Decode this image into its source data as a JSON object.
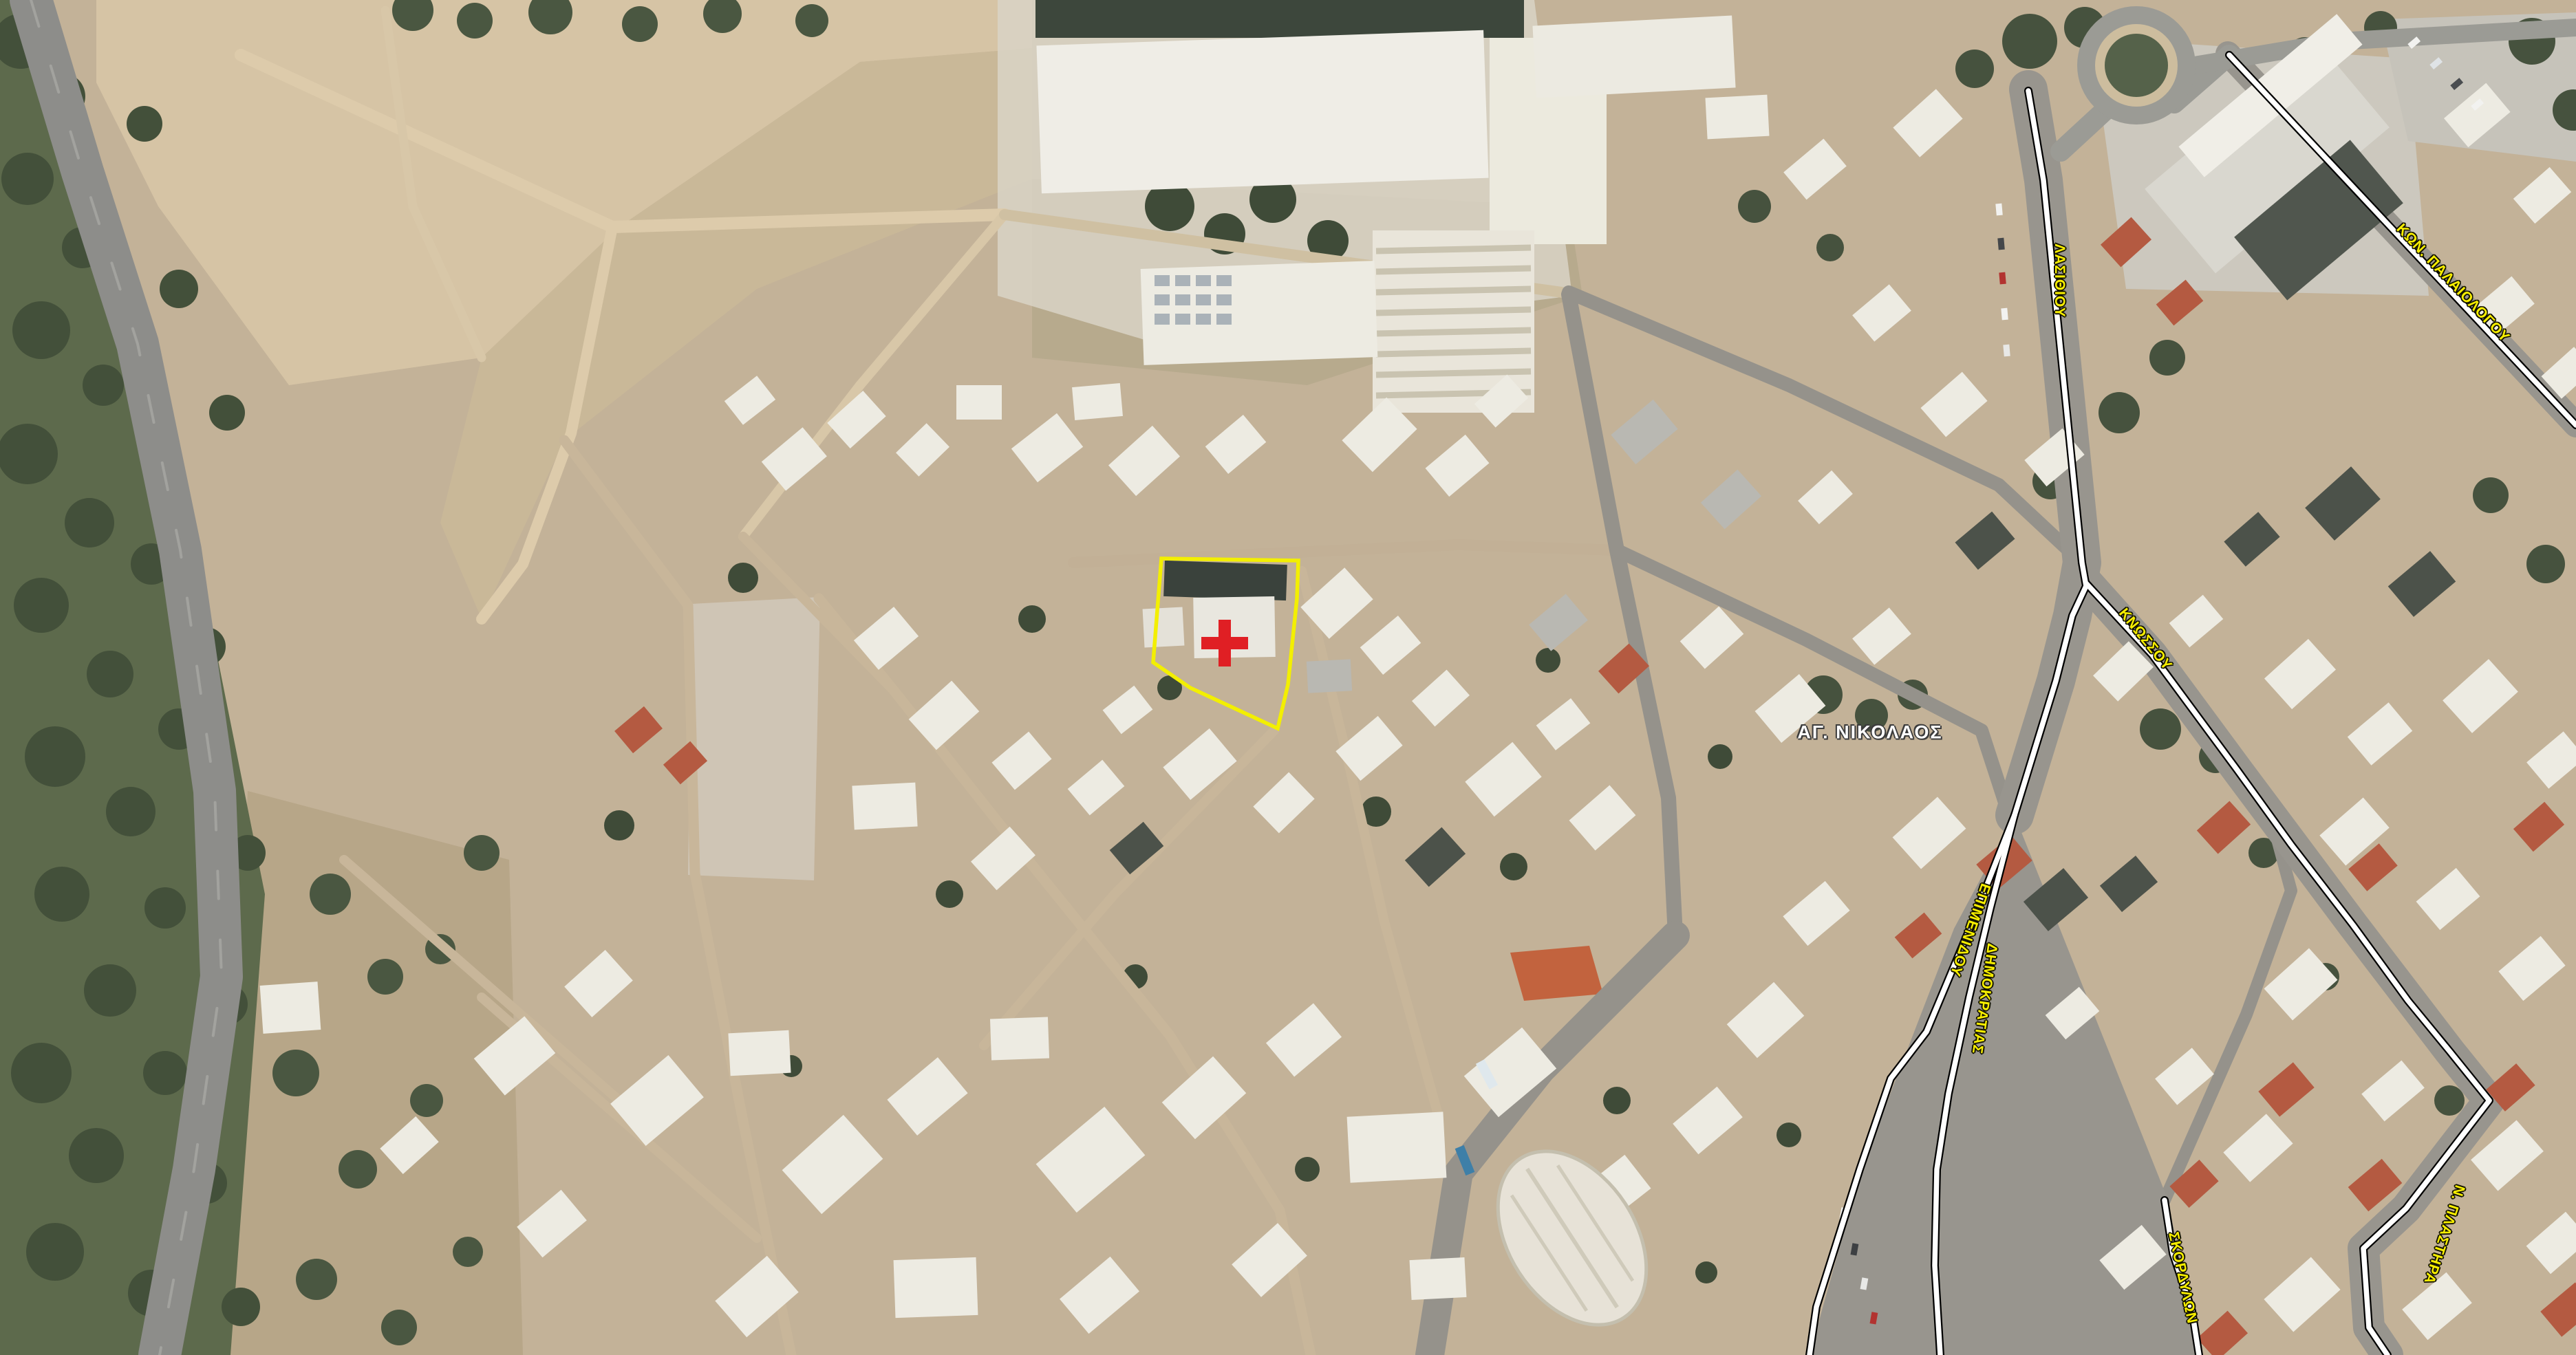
{
  "map": {
    "type": "aerial-satellite-map",
    "place_label": "ΑΓ. ΝΙΚΟΛΑΟΣ",
    "street_labels": {
      "kon_palaiologou": "ΚΩΝ. ΠΑΛΑΙΟΛΟΓΟΥ",
      "lasithiou": "ΛΑΣΙΘΙΟΥ",
      "knossou": "ΚΝΩΣΣΟΥ",
      "epimenidou": "ΕΠΙΜΕΝΙΔΟΥ",
      "dimokratias": "ΔΗΜΟΚΡΑΤΙΑΣ",
      "skordylon": "ΣΚΟΡΔΥΛΩΝ",
      "n_plastira": "Ν. ΠΛΑΣΤΗΡΑ"
    },
    "marker": {
      "type": "red-cross",
      "description": "selected site marker inside yellow parcel outline"
    },
    "colors": {
      "parcel_outline": "#f3ef00",
      "marker_red": "#e01f24",
      "street_label_fill": "#f8ef00",
      "street_label_outline": "#141400",
      "place_label_fill": "#ffffff",
      "place_label_outline": "#3c3c3c",
      "road_fill": "#ffffff",
      "road_casing": "#000000"
    }
  }
}
